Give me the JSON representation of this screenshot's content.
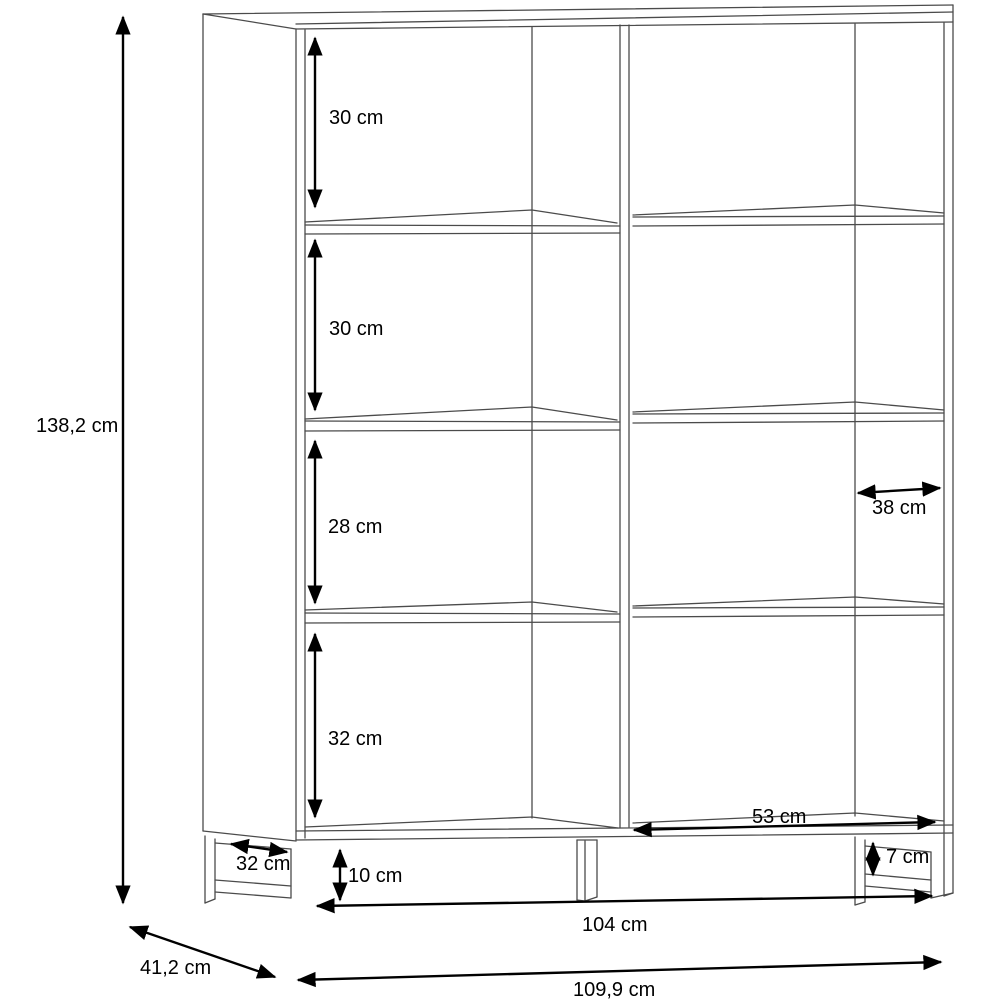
{
  "figure": {
    "kind": "furniture-dimension-line-drawing",
    "unit": "cm"
  },
  "colors": {
    "background": "#ffffff",
    "furniture_lines": "#4b4b4b",
    "dimension_lines": "#000000"
  },
  "labels": {
    "total_height": "138,2 cm",
    "compartment_top": "30 cm",
    "compartment_second": "30 cm",
    "compartment_third": "28 cm",
    "compartment_bottom": "32 cm",
    "interior_depth": "38 cm",
    "bottom_right_opening_width": "53 cm",
    "foot_depth": "32 cm",
    "base_height": "10 cm",
    "right_foot_height": "7 cm",
    "inner_width": "104 cm",
    "overall_width": "109,9 cm",
    "overall_depth": "41,2 cm"
  }
}
